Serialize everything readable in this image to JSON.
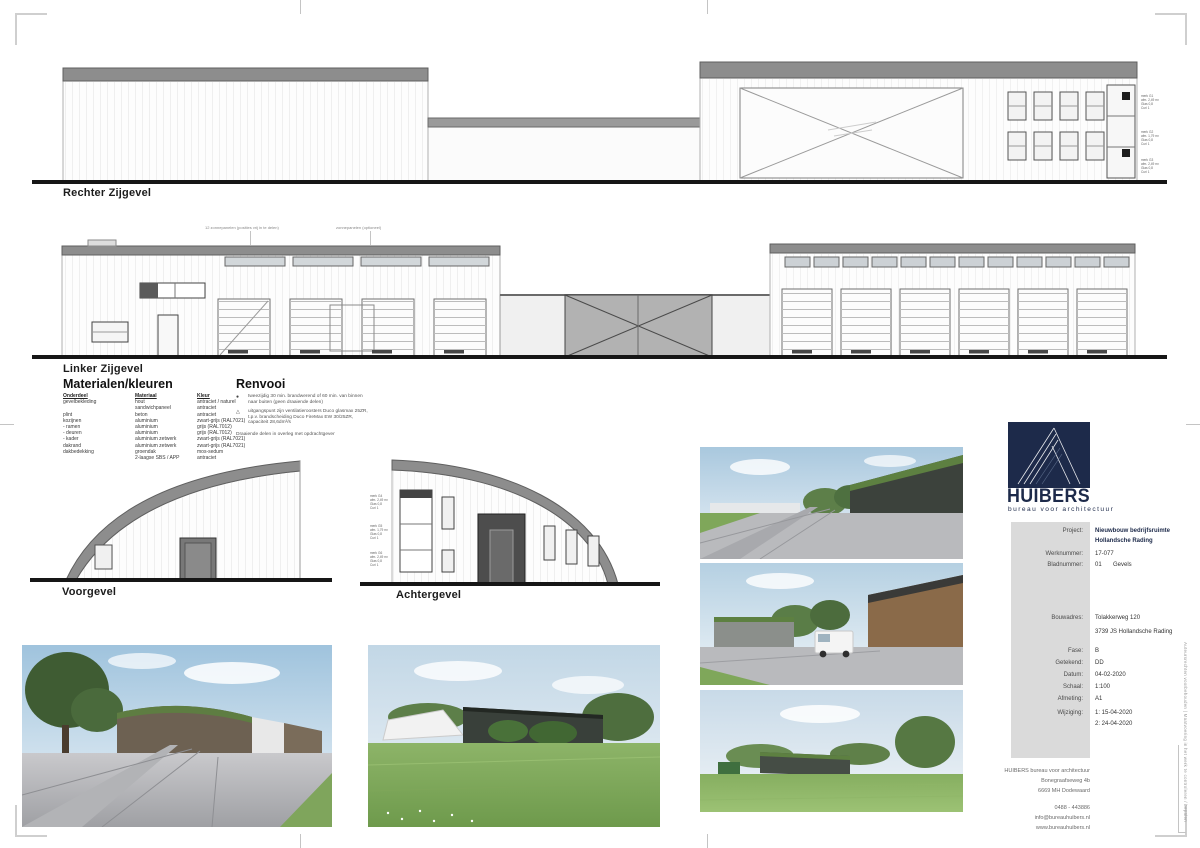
{
  "colors": {
    "logo_navy": "#1d2a4a",
    "panel_gray": "#dadada",
    "roof_gray": "#8d8d8d",
    "ground_black": "#161616",
    "green_roof": "#5d8041",
    "grass_green": "#7fa75a"
  },
  "elevations": {
    "rechter": {
      "label": "Rechter Zijgevel"
    },
    "linker": {
      "label": "Linker Zijgevel"
    },
    "voor": {
      "label": "Voorgevel"
    },
    "achter": {
      "label": "Achtergevel"
    }
  },
  "notes": {
    "panels_left": "12 zonnepanelen (posities vrij in te delen)",
    "panels_right": "zonnepanelen (optioneel)",
    "edge": "Auteursrechten voorbehouden  |  Maatvoering in het werk te controleren / bepalen"
  },
  "window_tags": {
    "t1": [
      "merk G1",
      "afm. 2,49 m²",
      "Glas 0,8",
      "Curi 1"
    ],
    "t2": [
      "merk G2",
      "afm. 1,79 m²",
      "Glas 0,8",
      "Curi 1"
    ],
    "t3": [
      "merk G3",
      "afm. 2,49 m²",
      "Glas 0,8",
      "Curi 1"
    ],
    "a1": [
      "merk G4",
      "afm. 2,49 m²",
      "Glas 0,8",
      "Curi 1"
    ],
    "a2": [
      "merk G5",
      "afm. 1,79 m²",
      "Glas 0,8",
      "Curi 1"
    ],
    "a3": [
      "merk G6",
      "afm. 2,49 m²",
      "Glas 0,8",
      "Curi 1"
    ]
  },
  "materialen": {
    "title": "Materialen/kleuren",
    "headers": [
      "Onderdeel",
      "Materiaal",
      "Kleur"
    ],
    "rows": [
      [
        "gevelbekleding",
        "hout",
        "antraciet / naturel"
      ],
      [
        "",
        "sandwichpaneel",
        "antraciet"
      ],
      [
        "plint",
        "beton",
        "antraciet"
      ],
      [
        "kozijnen",
        "aluminium",
        "zwart-grijs (RAL7021)"
      ],
      [
        "- ramen",
        "aluminium",
        "grijs (RAL7012)"
      ],
      [
        "- deuren",
        "aluminium",
        "grijs (RAL7012)"
      ],
      [
        "- kader",
        "aluminium zetwerk",
        "zwart-grijs (RAL7021)"
      ],
      [
        "dakrand",
        "aluminium zetwerk",
        "zwart-grijs (RAL7021)"
      ],
      [
        "dakbedekking",
        "groendak",
        "mos-sedum"
      ],
      [
        "",
        "2-laagse SBS / APP",
        "antraciet"
      ]
    ]
  },
  "renvooi": {
    "title": "Renvooi",
    "item1_symbol": "dot-symbol",
    "item1": "tweezijdig 30 min. brandwerend of 60 min. van binnen naar buiten (geen draaiende delen)",
    "item2_symbol": "triangle-symbol",
    "item2": "uitgangspunt zijn ventilatieroosters Duco glasmax 25ZR, t.p.v. brandscheiding Duco FireMax EW 30/25ZR, capaciteit 28,6dm³/s",
    "footer": "Draaiende delen in overleg met opdrachtgever"
  },
  "titleblock": {
    "logo_word": "HUIBERS",
    "logo_tagline": "bureau voor architectuur",
    "project_label": "Project:",
    "project_value1": "Nieuwbouw bedrijfsruimte",
    "project_value2": "Hollandsche Rading",
    "werknummer_label": "Werknummer:",
    "werknummer_value": "17-077",
    "bladnummer_label": "Bladnummer:",
    "bladnummer_value_a": "01",
    "bladnummer_value_b": "Gevels",
    "bouwadres_label": "Bouwadres:",
    "bouwadres_value1": "Tolakkerweg 120",
    "bouwadres_value2": "3739 JS Hollandsche Rading",
    "fase_label": "Fase:",
    "fase_value": "B",
    "getekend_label": "Getekend:",
    "getekend_value": "DD",
    "datum_label": "Datum:",
    "datum_value": "04-02-2020",
    "schaal_label": "Schaal:",
    "schaal_value": "1:100",
    "afmeting_label": "Afmeting:",
    "afmeting_value": "A1",
    "wijziging_label": "Wijziging:",
    "wijziging_value1": "1: 15-04-2020",
    "wijziging_value2": "2: 24-04-2020"
  },
  "office": {
    "line1": "HUIBERS bureau voor architectuur",
    "line2": "Bonegraafseweg 4b",
    "line3": "6669 MH Dodewaard",
    "phone": "0488 - 443886",
    "email": "info@bureauhuibers.nl",
    "web": "www.bureauhuibers.nl"
  }
}
